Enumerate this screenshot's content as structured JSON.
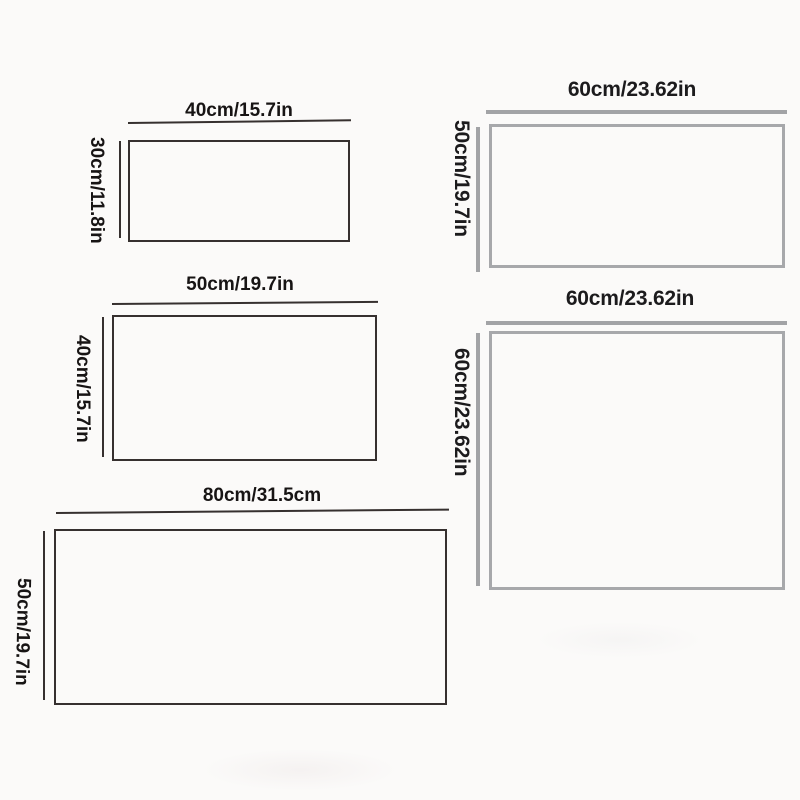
{
  "page": {
    "description": "Product size chart with five rectangle dimension diagrams",
    "background_color": "#fbfaf9"
  },
  "colors": {
    "dark_line": "#36302f",
    "gray_line": "#a2a3a6",
    "text": "#171414"
  },
  "diagrams": [
    {
      "id": "rect-40x30",
      "style": "dark",
      "width_label": "40cm/15.7in",
      "height_label": "30cm/11.8in"
    },
    {
      "id": "rect-50x40",
      "style": "dark",
      "width_label": "50cm/19.7in",
      "height_label": "40cm/15.7in"
    },
    {
      "id": "rect-80x50",
      "style": "dark",
      "width_label": "80cm/31.5cm",
      "height_label": "50cm/19.7in"
    },
    {
      "id": "rect-60x50",
      "style": "gray",
      "width_label": "60cm/23.62in",
      "height_label": "50cm/19.7in"
    },
    {
      "id": "rect-60x60",
      "style": "gray",
      "width_label": "60cm/23.62in",
      "height_label": "60cm/23.62in"
    }
  ]
}
